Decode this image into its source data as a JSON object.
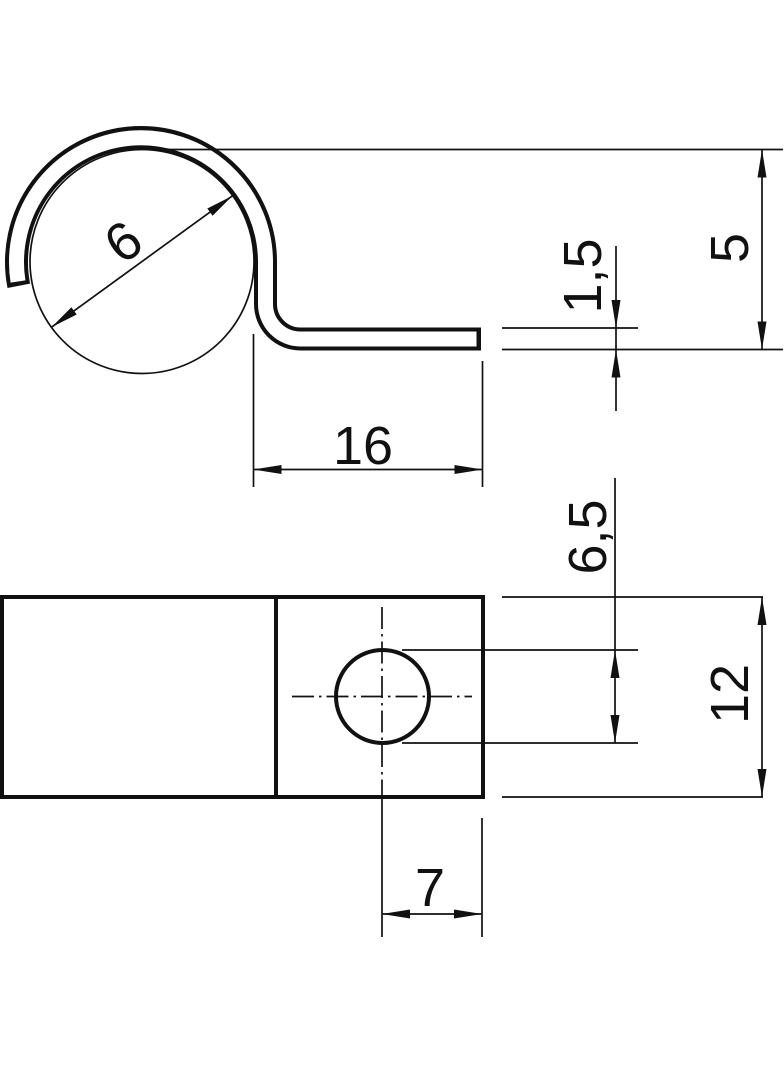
{
  "drawing": {
    "colors": {
      "line": "#111111",
      "background": "#ffffff"
    },
    "views": {
      "side_view": {
        "dimensions": {
          "cable_diameter": "6",
          "tail_length": "16",
          "material_thickness": "1,5",
          "tail_height": "5"
        }
      },
      "plan_view": {
        "dimensions": {
          "hole_diameter": "6,5",
          "plate_width": "12",
          "hole_to_edge": "7"
        }
      }
    }
  }
}
